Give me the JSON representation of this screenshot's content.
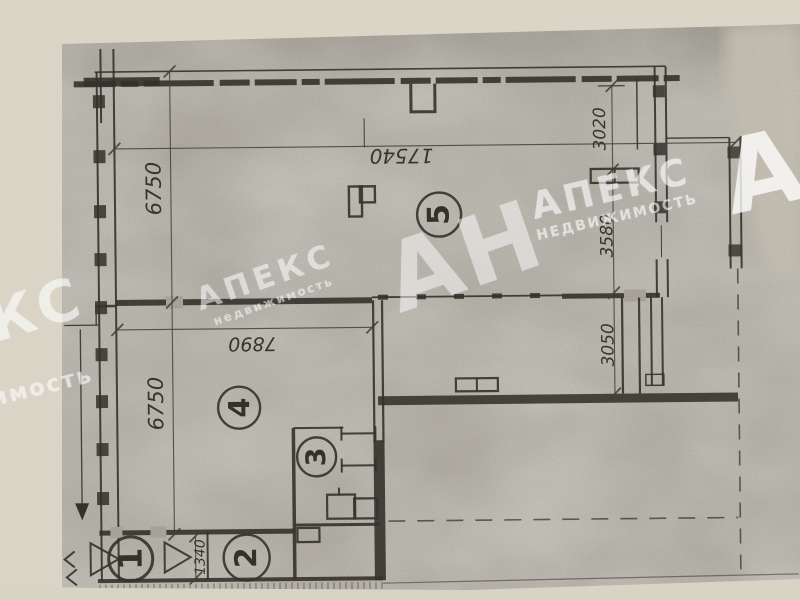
{
  "scan": {
    "rooms": [
      {
        "number": "1"
      },
      {
        "number": "2"
      },
      {
        "number": "3"
      },
      {
        "number": "4"
      },
      {
        "number": "5"
      }
    ],
    "dimensions": {
      "total_width": "17540",
      "left_upper_height": "6750",
      "left_lower_height": "6750",
      "right_top": "3020",
      "right_middle": "3580",
      "right_bottom": "3050",
      "room4_width": "7890",
      "entry_width": "1340"
    },
    "watermark": {
      "initials": "АН",
      "agency": "АПЕКС",
      "agency_sub": "НЕДВИЖИМОСТЬ",
      "agency_sub_lower": "недвижимость"
    },
    "colors": {
      "paper": "#d8d3c5",
      "scan_background": "#b6b2a8",
      "ink": "#2b2822",
      "watermark": "#ffffff"
    }
  }
}
